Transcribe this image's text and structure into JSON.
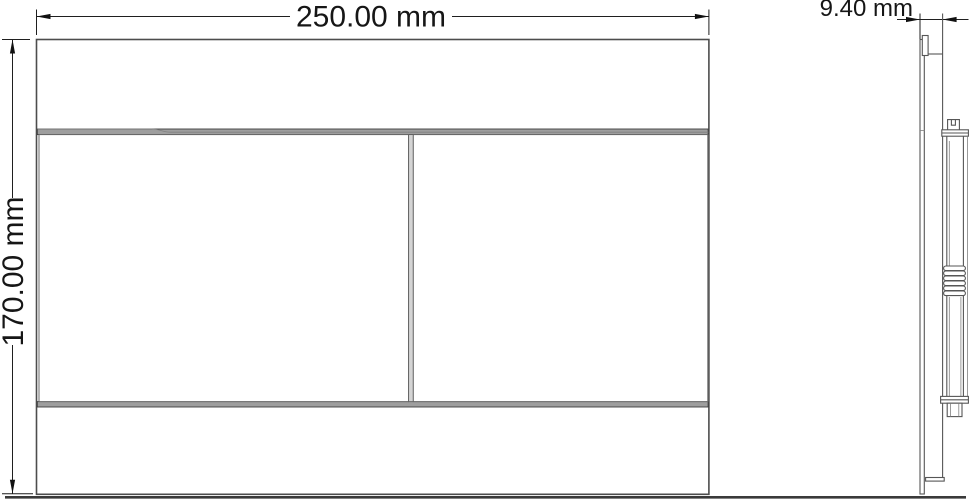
{
  "drawing": {
    "dimensions": {
      "width": "250.00 mm",
      "height": "170.00 mm",
      "depth": "9.40 mm"
    },
    "colors": {
      "background": "#ffffff",
      "outline": "#4d4d4d",
      "inner_line": "#6a6a6a",
      "gap_band": "#9e9e9e",
      "dimension_line": "#1f1f1f",
      "arrow": "#111111",
      "text": "#161616",
      "ground_line": "#3a3a3a"
    }
  }
}
